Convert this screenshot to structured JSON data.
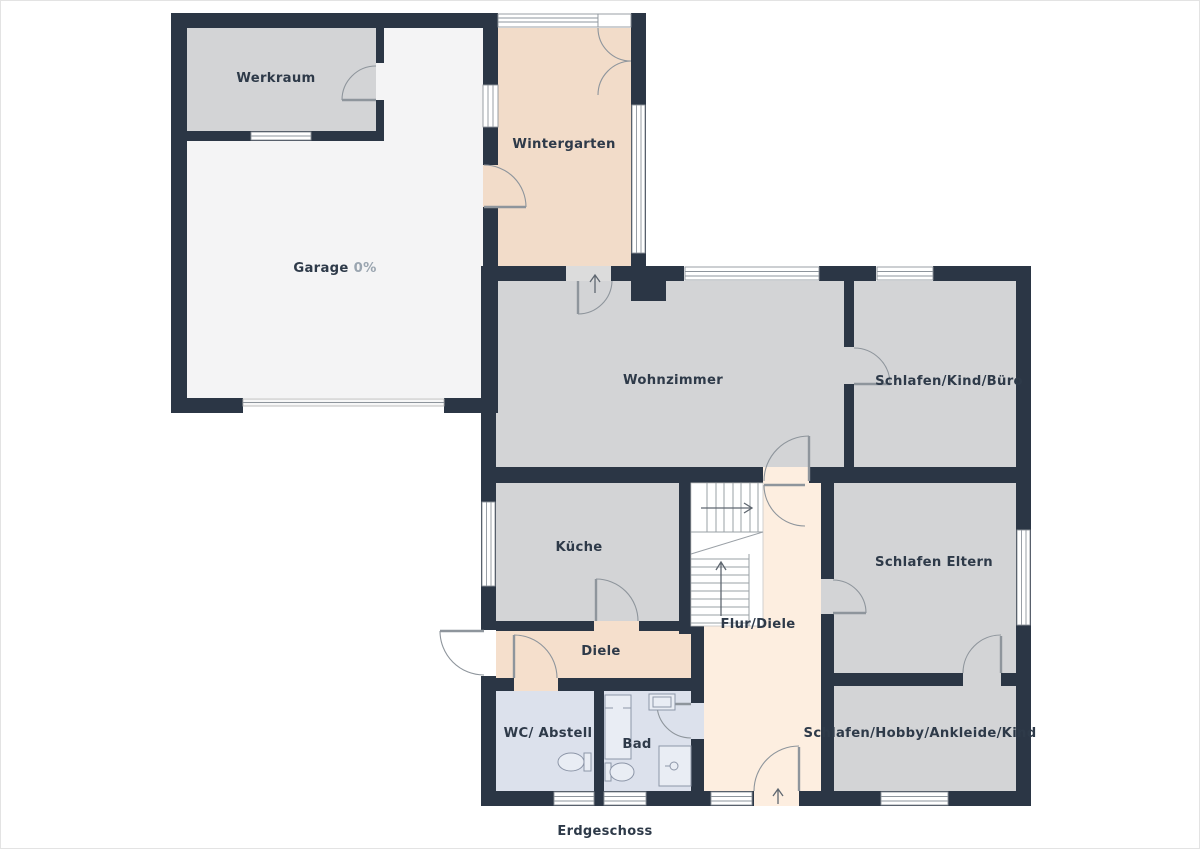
{
  "floor_label": "Erdgeschoss",
  "rooms": {
    "werkraum": {
      "label": "Werkraum"
    },
    "garage": {
      "label": "Garage",
      "value": "0%"
    },
    "wintergarten": {
      "label": "Wintergarten"
    },
    "wohnzimmer": {
      "label": "Wohnzimmer"
    },
    "schlafen_kind_buero": {
      "label": "Schlafen/Kind/Büro"
    },
    "kueche": {
      "label": "Küche"
    },
    "flur_diele": {
      "label": "Flur/Diele"
    },
    "diele": {
      "label": "Diele"
    },
    "schlafen_eltern": {
      "label": "Schlafen Eltern"
    },
    "wc_abstell": {
      "label": "WC/ Abstell"
    },
    "bad": {
      "label": "Bad"
    },
    "schlafen_hobby": {
      "label": "Schlafen/Hobby/Ankleide/Kind"
    }
  },
  "colors": {
    "wall": "#2b3645",
    "gray": "#d3d4d6",
    "garage": "#f4f4f5",
    "winter": "#f2dcc9",
    "diele": "#f5dfcc",
    "flur": "#fdeee0",
    "bath": "#dce1ec",
    "threshold": "#dcdcdc",
    "line": "#8e959c",
    "stair": "#9aa0a6",
    "text": "#2e3a49",
    "muted": "#9aa5b0",
    "border": "#e3e3e3",
    "fixture": "#e9edf4",
    "fixture_line": "#8d96a8"
  }
}
